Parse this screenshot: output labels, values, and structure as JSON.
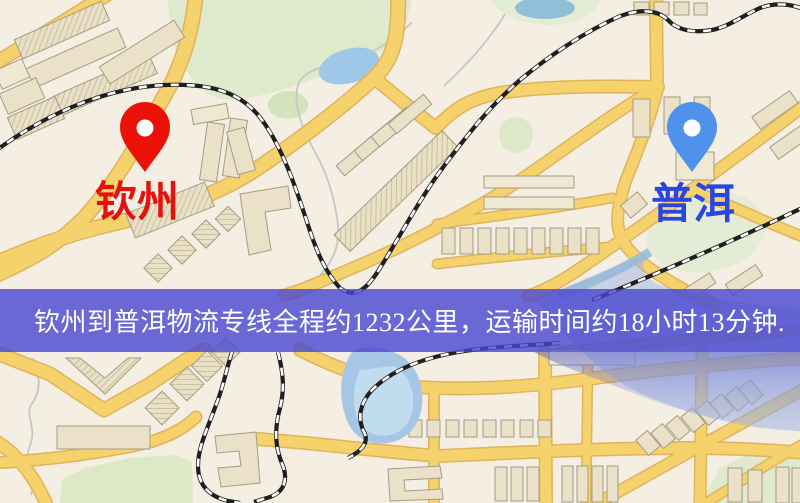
{
  "banner": {
    "text": "钦州到普洱物流专线全程约1232公里，运输时间约18小时13分钟.",
    "bg_color": "rgba(71,70,208,0.8)",
    "text_color": "#ffffff"
  },
  "route": {
    "origin_city": "钦州",
    "destination_city": "普洱",
    "distance_text": "约1232公里",
    "duration_text": "约18小时13分钟"
  },
  "markers": {
    "origin": {
      "label": "钦州",
      "pin_color": "#ea1208",
      "label_color": "#e8100c"
    },
    "destination": {
      "label": "普洱",
      "pin_color": "#4f92ec",
      "label_color": "#2b46df"
    }
  },
  "map": {
    "style_colors": {
      "background": "#f4eee3",
      "major_road": "#f6d26d",
      "road_casing": "#e0b35c",
      "park_green": "#dfe9cc",
      "water_blue": "#a6c6e6",
      "building_tan": "#eae1c8",
      "railway_black": "#1f1f1f"
    }
  }
}
